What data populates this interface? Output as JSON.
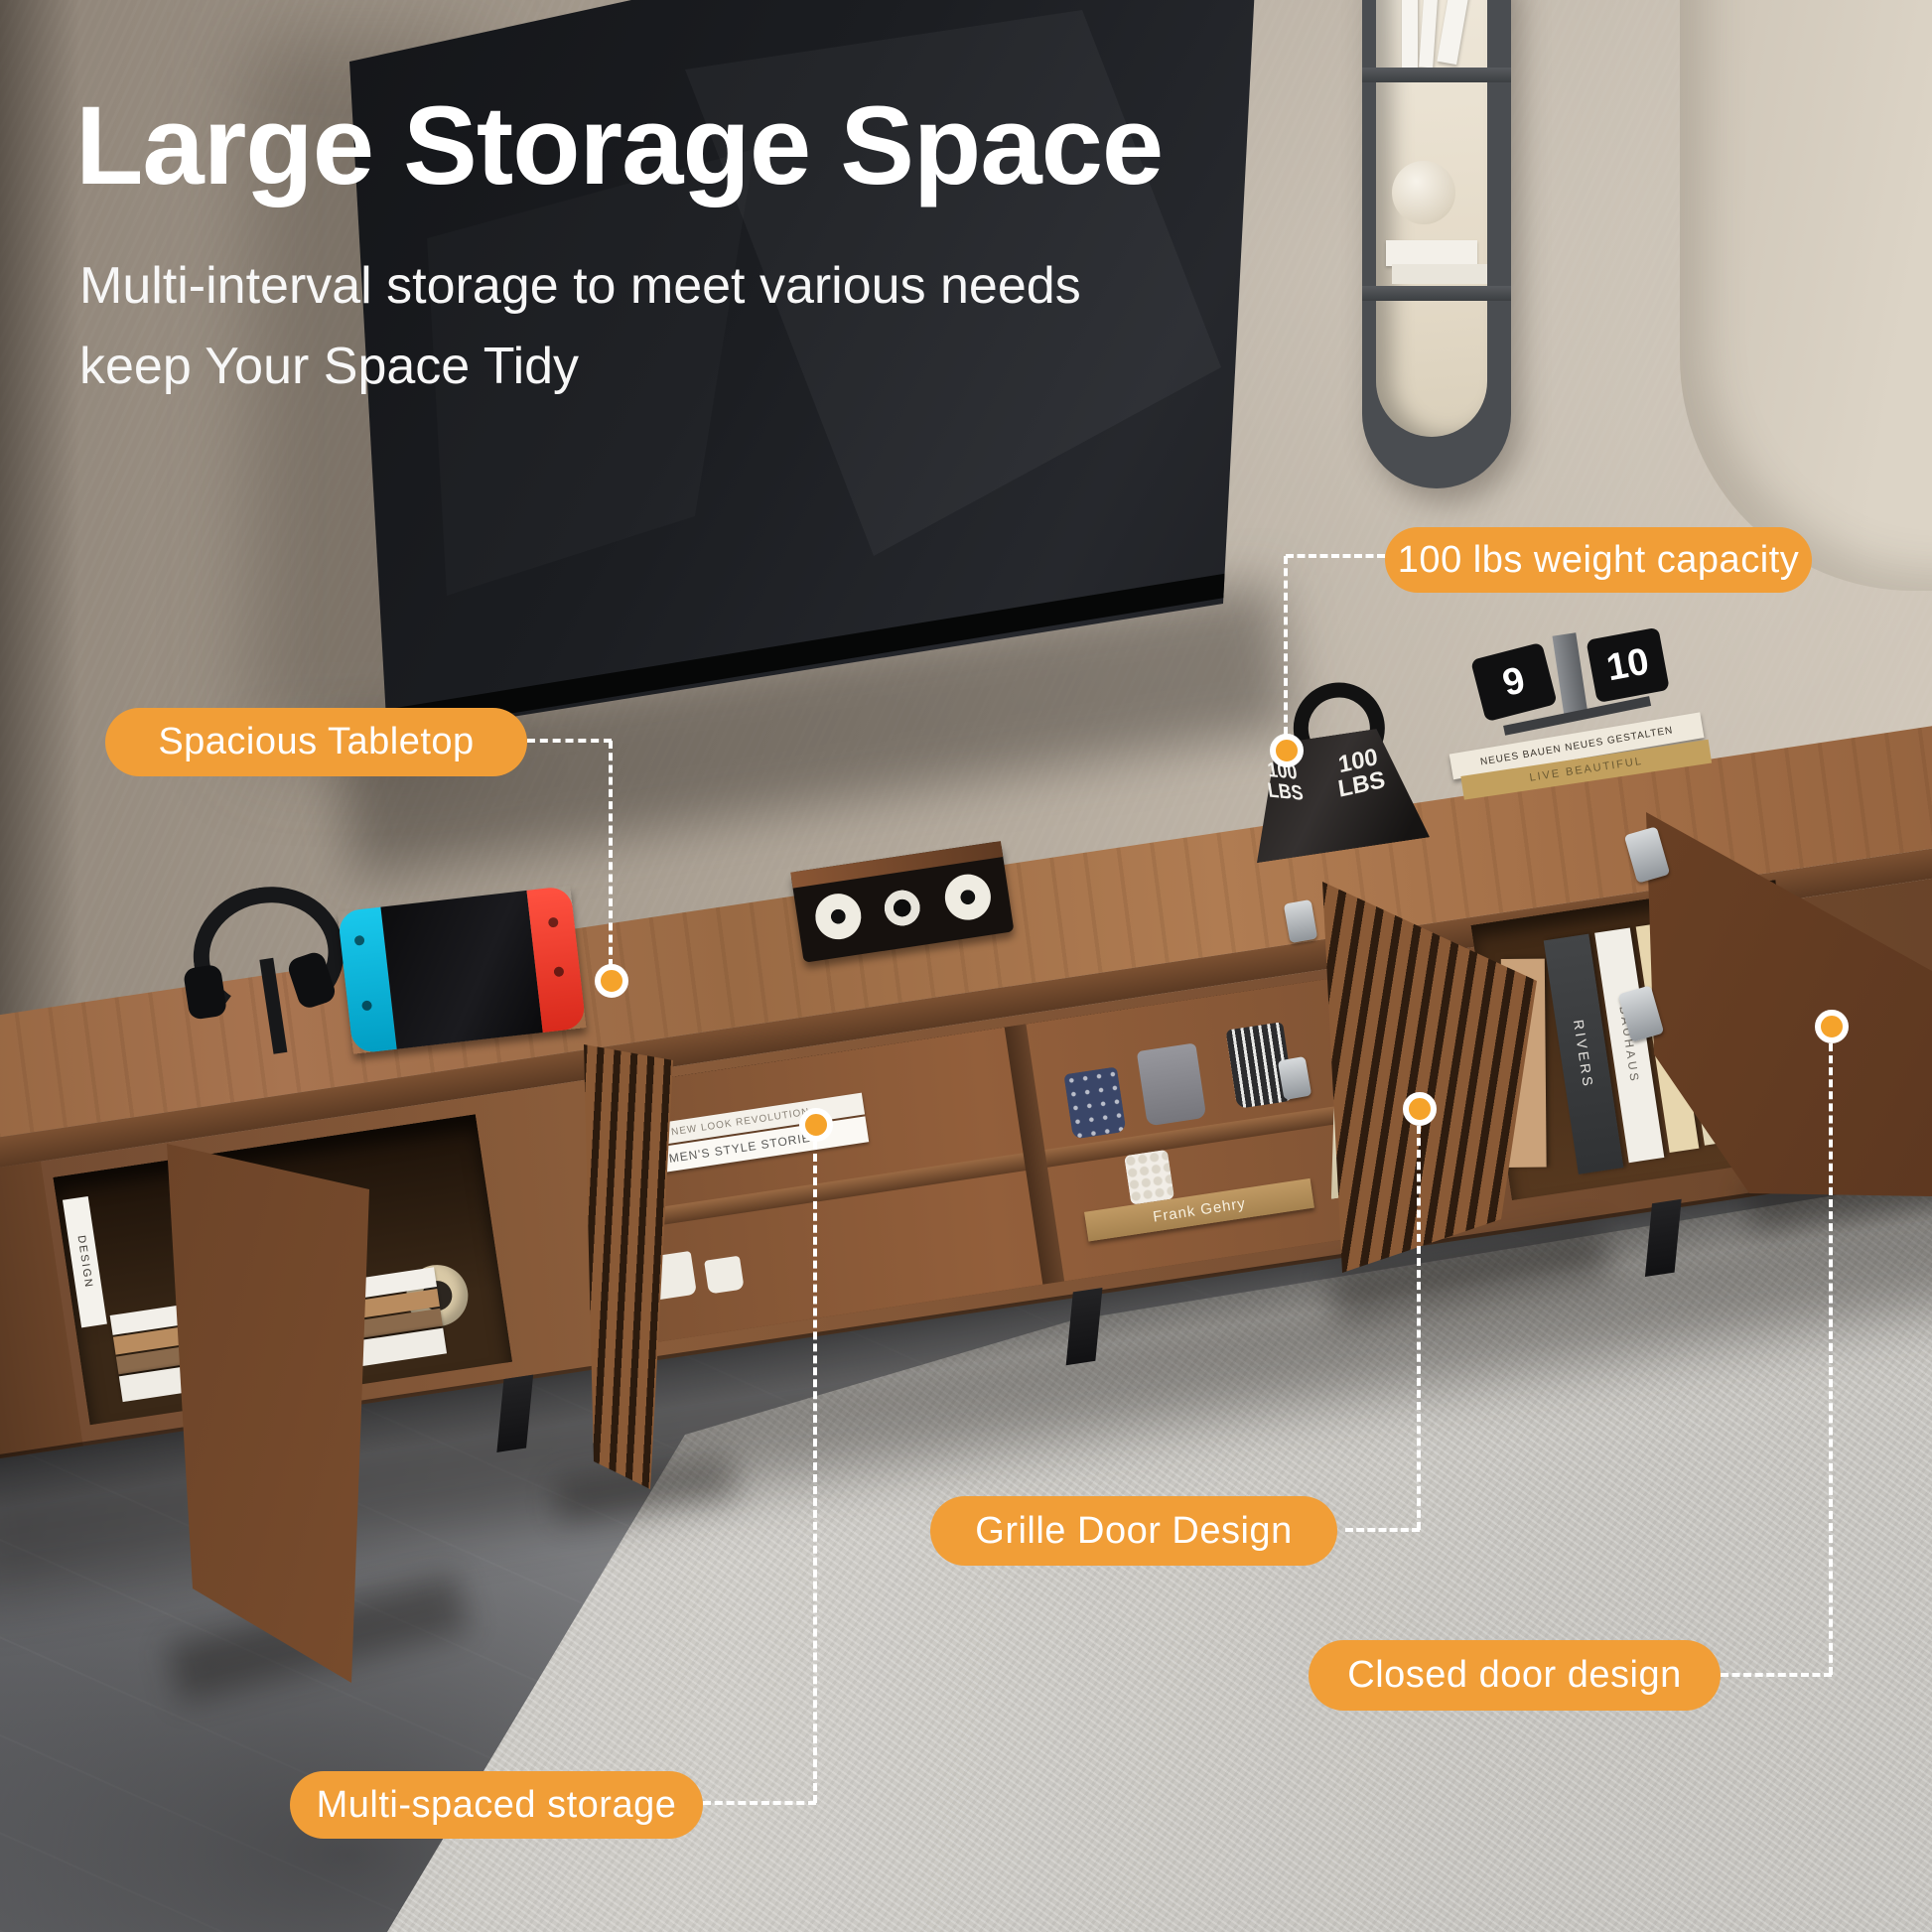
{
  "header": {
    "title": "Large Storage Space",
    "subtitle_line1": "Multi-interval storage to meet various needs",
    "subtitle_line2": "keep Your Space Tidy"
  },
  "callouts": [
    {
      "id": "weight-capacity",
      "label": "100 lbs weight capacity"
    },
    {
      "id": "spacious-tabletop",
      "label": "Spacious Tabletop"
    },
    {
      "id": "grille-door",
      "label": "Grille Door Design"
    },
    {
      "id": "closed-door",
      "label": "Closed door design"
    },
    {
      "id": "multi-spaced",
      "label": "Multi-spaced storage"
    }
  ],
  "props": {
    "weight_label": "100 LBS",
    "weight_line1": "100",
    "weight_line2": "LBS",
    "clock_left_digit": "9",
    "clock_right_digit": "10",
    "top_book_1": "NEUES BAUEN NEUES GESTALTEN",
    "top_book_2": "LIVE BEAUTIFUL",
    "gehry_book": "Frank Gehry",
    "cubby_book_1": "NEW LOOK REVOLUTION",
    "cubby_book_2": "MEN'S STYLE STORIES",
    "left_cabinet_book_1": "THIS IS HOME",
    "left_cabinet_book_2": "united kingdom",
    "left_cabinet_book_3": "bauhaus",
    "left_cabinet_book_4": "DESIGN",
    "right_book_1": "RIVERS",
    "right_book_2": "BAUHAUS",
    "right_book_3": "THE KINFOLK"
  },
  "colors": {
    "badge_orange": "#F19E37",
    "badge_text": "#FFFFFF",
    "connector_white": "#FFFFFF",
    "dot_orange": "#F5A32B",
    "title_text": "#FFFFFF",
    "wood": "#9A6A44",
    "wood_dark": "#5E3A22",
    "tv_black": "#17181B",
    "wall_taupe": "#B4AA9D",
    "floor_gray": "#7E7F82",
    "rug_gray": "#CBC9C4",
    "joycon_blue": "#00B9E8",
    "joycon_red": "#FF3C28"
  }
}
